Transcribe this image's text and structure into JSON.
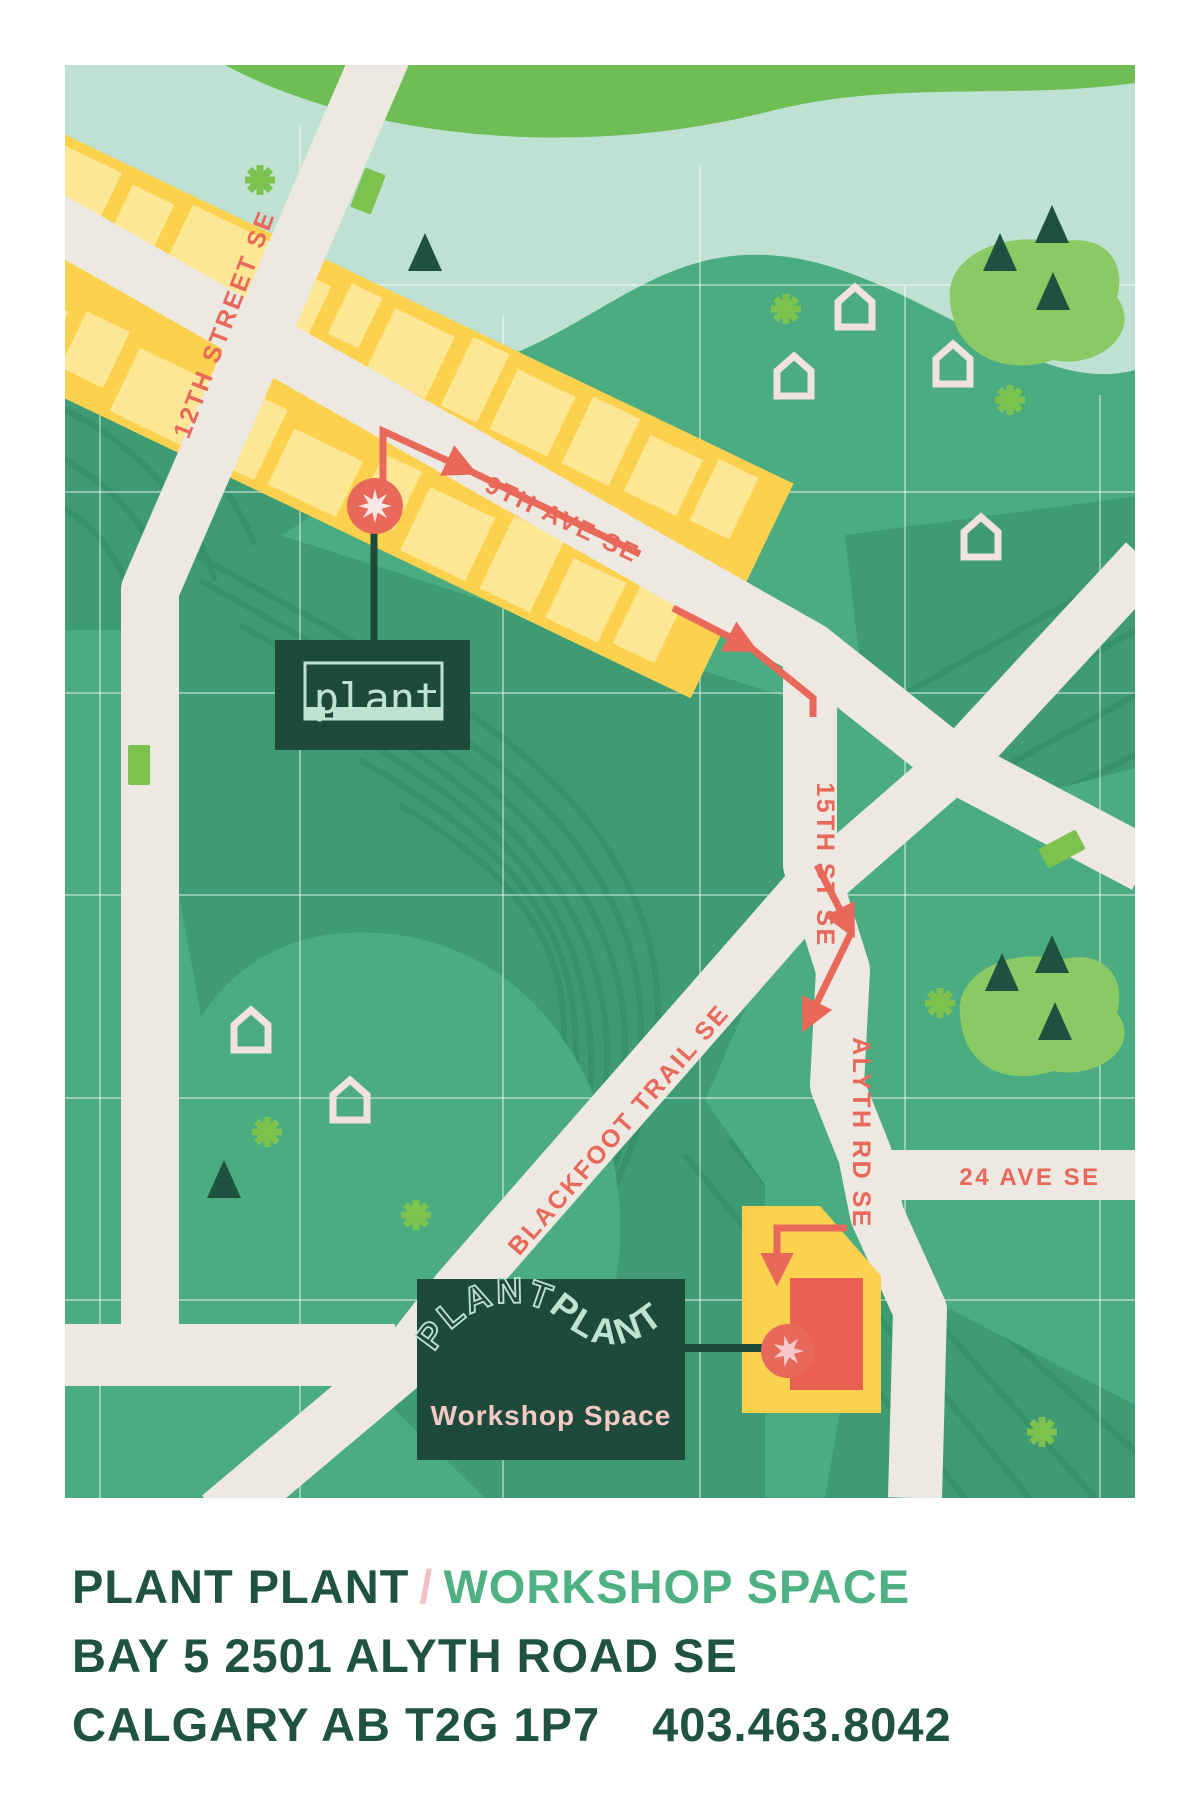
{
  "map": {
    "street_labels": {
      "street_12th": "12TH STREET SE",
      "ave_9th": "9TH AVE SE",
      "st_15th": "15TH ST SE",
      "blackfoot": "BLACKFOOT TRAIL SE",
      "alyth": "ALYTH RD SE",
      "ave_24": "24 AVE SE"
    },
    "plant_sign": {
      "label": "plant"
    },
    "workshop_sign": {
      "word1": "PLANT",
      "word2": "PLANT",
      "subtitle": "Workshop Space"
    }
  },
  "caption": {
    "title_1": "PLANT PLANT",
    "separator": "/",
    "title_2": "WORKSHOP SPACE",
    "address": "BAY 5 2501 ALYTH ROAD SE",
    "city": "CALGARY AB T2G 1P7",
    "phone": "403.463.8042"
  },
  "colors": {
    "background": "#FFFFFF",
    "map_green": "#4CAC81",
    "dark_swath_green": "#3E9B73",
    "track_line_green": "#35926B",
    "river_mint": "#BFE1D3",
    "top_band_green": "#6FBE55",
    "tree_blob_green": "#8BC964",
    "accent_green": "#7CC24E",
    "block_yellow": "#FCD14D",
    "building_yellow": "#FDE794",
    "road_cream": "#EDE8E2",
    "route_coral": "#E8695A",
    "destination_red": "#E96052",
    "start_star": "#F7E7E5",
    "destination_star": "#F4C7CC",
    "sign_dark_green": "#1E4A3B",
    "sign_mint_text": "#BEE3D2",
    "sign_pink_text": "#F5C9C4",
    "caption_dark_green": "#1F5340",
    "caption_green": "#4FB183",
    "caption_pink": "#F3BFC5"
  }
}
